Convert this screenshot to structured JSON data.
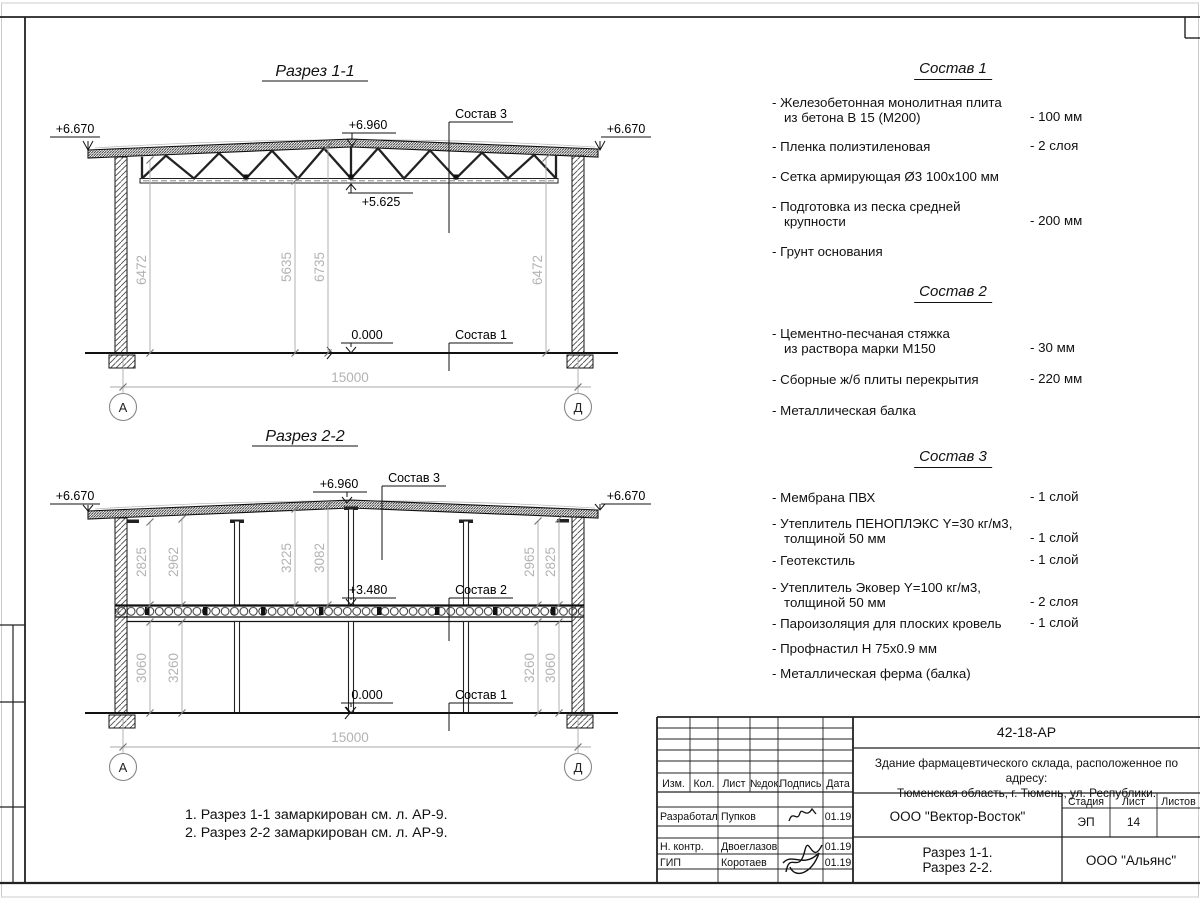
{
  "sections": {
    "s1": {
      "title": "Разрез 1-1",
      "elev_left": "+6.670",
      "elev_right": "+6.670",
      "elev_ridge": "+6.960",
      "elev_chord": "+5.625",
      "elev_zero": "0.000",
      "leader_roof": "Состав 3",
      "leader_floor": "Состав 1",
      "dim_left": "6472",
      "dim_mid_inner": "5635",
      "dim_mid_outer": "6735",
      "dim_right": "6472",
      "span": "15000",
      "axis_left": "А",
      "axis_right": "Д"
    },
    "s2": {
      "title": "Разрез 2-2",
      "elev_left": "+6.670",
      "elev_right": "+6.670",
      "elev_ridge": "+6.960",
      "elev_slab": "+3.480",
      "elev_zero": "0.000",
      "leader_roof": "Состав 3",
      "leader_slab": "Состав 2",
      "leader_floor": "Состав 1",
      "dims_upper": [
        "2825",
        "2962",
        "3225",
        "3082",
        "2965",
        "2825"
      ],
      "dims_lower": [
        "3060",
        "3260",
        "3260",
        "3060"
      ],
      "span": "15000",
      "axis_left": "А",
      "axis_right": "Д"
    }
  },
  "compositions": [
    {
      "title": "Состав 1",
      "items": [
        {
          "text": "- Железобетонная  монолитная плита\nиз бетона В 15 (М200)",
          "value": "- 100 мм"
        },
        {
          "text": "- Пленка полиэтиленовая",
          "value": "- 2 слоя"
        },
        {
          "text": "- Сетка армирующая Ø3 100х100 мм",
          "value": ""
        },
        {
          "text": "- Подготовка из песка средней\nкрупности",
          "value": "- 200 мм"
        },
        {
          "text": "- Грунт основания",
          "value": ""
        }
      ]
    },
    {
      "title": "Состав 2",
      "items": [
        {
          "text": "- Цементно-песчаная стяжка\nиз раствора марки М150",
          "value": "- 30 мм"
        },
        {
          "text": "- Сборные ж/б плиты перекрытия",
          "value": "- 220 мм"
        },
        {
          "text": "- Металлическая балка",
          "value": ""
        }
      ]
    },
    {
      "title": "Состав 3",
      "items": [
        {
          "text": "- Мембрана ПВХ",
          "value": "- 1 слой"
        },
        {
          "text": "- Утеплитель ПЕНОПЛЭКС Y=30 кг/м3,\nтолщиной 50 мм",
          "value": "- 1 слой"
        },
        {
          "text": "- Геотекстиль",
          "value": "- 1 слой"
        },
        {
          "text": "- Утеплитель Эковер Y=100 кг/м3,\nтолщиной 50 мм",
          "value": "- 2 слоя"
        },
        {
          "text": "- Пароизоляция для плоских кровель",
          "value": "- 1 слой"
        },
        {
          "text": "- Профнастил Н 75х0.9 мм",
          "value": ""
        },
        {
          "text": "- Металлическая ферма (балка)",
          "value": ""
        }
      ]
    }
  ],
  "notes": [
    "1. Разрез 1-1 замаркирован см. л. АР-9.",
    "2. Разрез 2-2 замаркирован см. л. АР-9."
  ],
  "title_block": {
    "doc_code": "42-18-АР",
    "project": "Здание фармацевтического склада, расположенное по адресу:\nТюменская область, г. Тюмень, ул. Республики.",
    "col_izm": "Изм.",
    "col_kol": "Кол.",
    "col_list": "Лист",
    "col_doc": "№док.",
    "col_sign": "Подпись",
    "col_date": "Дата",
    "rows": [
      {
        "role": "Разработал",
        "name": "Пупков",
        "date": "01.19"
      },
      {
        "role": "Н. контр.",
        "name": "Двоеглазов",
        "date": "01.19"
      },
      {
        "role": "ГИП",
        "name": "Коротаев",
        "date": "01.19"
      }
    ],
    "company": "ООО \"Вектор-Восток\"",
    "stage_label": "Стадия",
    "list_label": "Лист",
    "lists_label": "Листов",
    "stage": "ЭП",
    "sheet_no": "14",
    "sheets_total": "",
    "drawing_name": "Разрез 1-1.\nРазрез 2-2.",
    "contractor": "ООО \"Альянс\""
  }
}
